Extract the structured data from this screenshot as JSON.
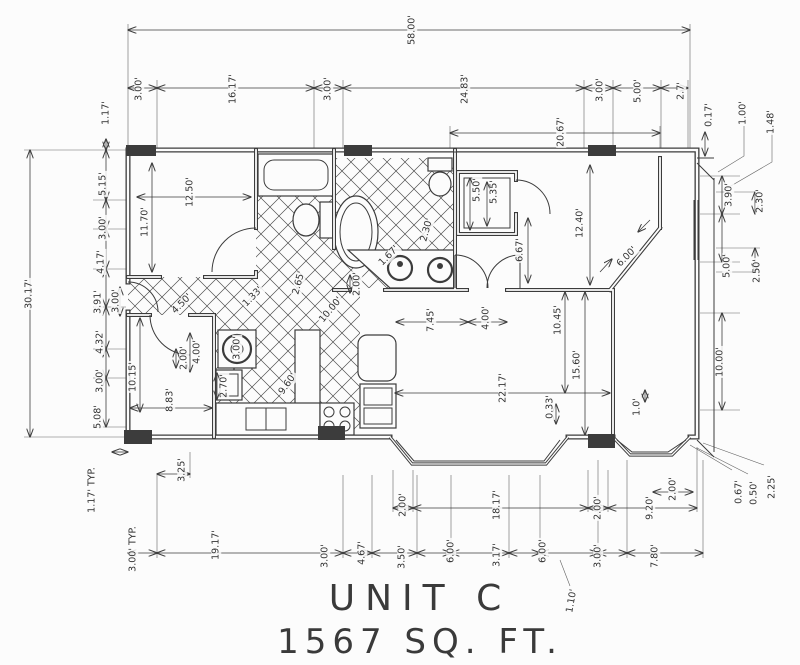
{
  "title": {
    "line1": "UNIT C",
    "line2": "1567 SQ. FT."
  },
  "colors": {
    "ink": "#3c3c3c",
    "paper": "#fcfcfc"
  },
  "dimensions": [
    {
      "t": "58.00'",
      "x": 412,
      "y": 30,
      "r": -90
    },
    {
      "t": "3.00'",
      "x": 139,
      "y": 89,
      "r": -90
    },
    {
      "t": "16.17'",
      "x": 233,
      "y": 89,
      "r": -90
    },
    {
      "t": "3.00'",
      "x": 328,
      "y": 89,
      "r": -90
    },
    {
      "t": "24.83'",
      "x": 465,
      "y": 89,
      "r": -90
    },
    {
      "t": "3.00'",
      "x": 600,
      "y": 90,
      "r": -90
    },
    {
      "t": "5.00'",
      "x": 638,
      "y": 91,
      "r": -90
    },
    {
      "t": "2.7'",
      "x": 681,
      "y": 91,
      "r": -90
    },
    {
      "t": "20.67'",
      "x": 561,
      "y": 132,
      "r": -90
    },
    {
      "t": "0.17'",
      "x": 709,
      "y": 115,
      "r": -90
    },
    {
      "t": "1.00'",
      "x": 743,
      "y": 113,
      "r": -90
    },
    {
      "t": "1.48'",
      "x": 771,
      "y": 122,
      "r": -90
    },
    {
      "t": "1.17'",
      "x": 106,
      "y": 113,
      "r": -90
    },
    {
      "t": "5.15'",
      "x": 103,
      "y": 184,
      "r": -90
    },
    {
      "t": "3.00'",
      "x": 103,
      "y": 228,
      "r": -90
    },
    {
      "t": "4.17'",
      "x": 101,
      "y": 262,
      "r": -90
    },
    {
      "t": "3.91'",
      "x": 98,
      "y": 302,
      "r": -90
    },
    {
      "t": "3.00'",
      "x": 116,
      "y": 301,
      "r": -90
    },
    {
      "t": "4.32'",
      "x": 100,
      "y": 342,
      "r": -90
    },
    {
      "t": "3.00'",
      "x": 100,
      "y": 381,
      "r": -90
    },
    {
      "t": "5.08'",
      "x": 98,
      "y": 417,
      "r": -90
    },
    {
      "t": "30.17'",
      "x": 29,
      "y": 294,
      "r": -90
    },
    {
      "t": "1.17' TYP.",
      "x": 92,
      "y": 490,
      "r": -90
    },
    {
      "t": "3.00' TYP.",
      "x": 133,
      "y": 549,
      "r": -90
    },
    {
      "t": "3.90'",
      "x": 729,
      "y": 195,
      "r": -90
    },
    {
      "t": "2.30'",
      "x": 760,
      "y": 201,
      "r": -90
    },
    {
      "t": "5.00'",
      "x": 727,
      "y": 266,
      "r": -90
    },
    {
      "t": "2.50'",
      "x": 757,
      "y": 271,
      "r": -90
    },
    {
      "t": "10.00'",
      "x": 720,
      "y": 362,
      "r": -90
    },
    {
      "t": "0.67'",
      "x": 739,
      "y": 492,
      "r": -90
    },
    {
      "t": "0.50'",
      "x": 754,
      "y": 493,
      "r": -90
    },
    {
      "t": "2.25'",
      "x": 772,
      "y": 487,
      "r": -90
    },
    {
      "t": "3.25'",
      "x": 182,
      "y": 470,
      "r": -90
    },
    {
      "t": "19.17'",
      "x": 216,
      "y": 545,
      "r": -90
    },
    {
      "t": "3.00'",
      "x": 325,
      "y": 556,
      "r": -90
    },
    {
      "t": "4.67'",
      "x": 362,
      "y": 553,
      "r": -90
    },
    {
      "t": "3.50'",
      "x": 402,
      "y": 557,
      "r": -90
    },
    {
      "t": "6.00'",
      "x": 451,
      "y": 551,
      "r": -90
    },
    {
      "t": "3.17'",
      "x": 497,
      "y": 555,
      "r": -90
    },
    {
      "t": "6.00'",
      "x": 543,
      "y": 551,
      "r": -90
    },
    {
      "t": "3.00'",
      "x": 598,
      "y": 556,
      "r": -90
    },
    {
      "t": "7.80'",
      "x": 655,
      "y": 556,
      "r": -90
    },
    {
      "t": "2.00'",
      "x": 403,
      "y": 505,
      "r": -90
    },
    {
      "t": "18.17'",
      "x": 497,
      "y": 505,
      "r": -90
    },
    {
      "t": "2.00'",
      "x": 598,
      "y": 508,
      "r": -90
    },
    {
      "t": "9.20'",
      "x": 650,
      "y": 508,
      "r": -90
    },
    {
      "t": "2.00'",
      "x": 673,
      "y": 489,
      "r": -90
    },
    {
      "t": "1.10'",
      "x": 572,
      "y": 601,
      "r": -80
    },
    {
      "t": "12.50'",
      "x": 190,
      "y": 192,
      "r": -90
    },
    {
      "t": "11.70'",
      "x": 145,
      "y": 222,
      "r": -90
    },
    {
      "t": "10.15'",
      "x": 133,
      "y": 377,
      "r": -90
    },
    {
      "t": "8.83'",
      "x": 170,
      "y": 400,
      "r": -90
    },
    {
      "t": "2.00'",
      "x": 184,
      "y": 358,
      "r": -90
    },
    {
      "t": "4.00'",
      "x": 197,
      "y": 352,
      "r": -90
    },
    {
      "t": "2.70'",
      "x": 224,
      "y": 386,
      "r": -90
    },
    {
      "t": "3.00'",
      "x": 237,
      "y": 348,
      "r": -90
    },
    {
      "t": "9.60'",
      "x": 288,
      "y": 384,
      "r": -55
    },
    {
      "t": "4.50'",
      "x": 182,
      "y": 304,
      "r": -45
    },
    {
      "t": "1.33'",
      "x": 253,
      "y": 297,
      "r": -45
    },
    {
      "t": "2.65'",
      "x": 299,
      "y": 283,
      "r": -75
    },
    {
      "t": "10.00'",
      "x": 331,
      "y": 310,
      "r": -50
    },
    {
      "t": "2.00'",
      "x": 357,
      "y": 284,
      "r": -90
    },
    {
      "t": "1.67'",
      "x": 389,
      "y": 256,
      "r": -45
    },
    {
      "t": "2.30'",
      "x": 427,
      "y": 230,
      "r": -75
    },
    {
      "t": "6.67'",
      "x": 520,
      "y": 250,
      "r": -90
    },
    {
      "t": "12.40'",
      "x": 580,
      "y": 223,
      "r": -90
    },
    {
      "t": "5.50'",
      "x": 477,
      "y": 190,
      "r": -90
    },
    {
      "t": "5.35'",
      "x": 494,
      "y": 192,
      "r": -90
    },
    {
      "t": "6.00'",
      "x": 627,
      "y": 257,
      "r": -45
    },
    {
      "t": "7.45'",
      "x": 431,
      "y": 320,
      "r": -90
    },
    {
      "t": "4.00'",
      "x": 486,
      "y": 318,
      "r": -90
    },
    {
      "t": "10.45'",
      "x": 558,
      "y": 320,
      "r": -90
    },
    {
      "t": "15.60'",
      "x": 577,
      "y": 365,
      "r": -90
    },
    {
      "t": "22.17'",
      "x": 503,
      "y": 388,
      "r": -90
    },
    {
      "t": "0.33'",
      "x": 550,
      "y": 407,
      "r": -90
    },
    {
      "t": "1.0'",
      "x": 637,
      "y": 407,
      "r": -90
    }
  ]
}
